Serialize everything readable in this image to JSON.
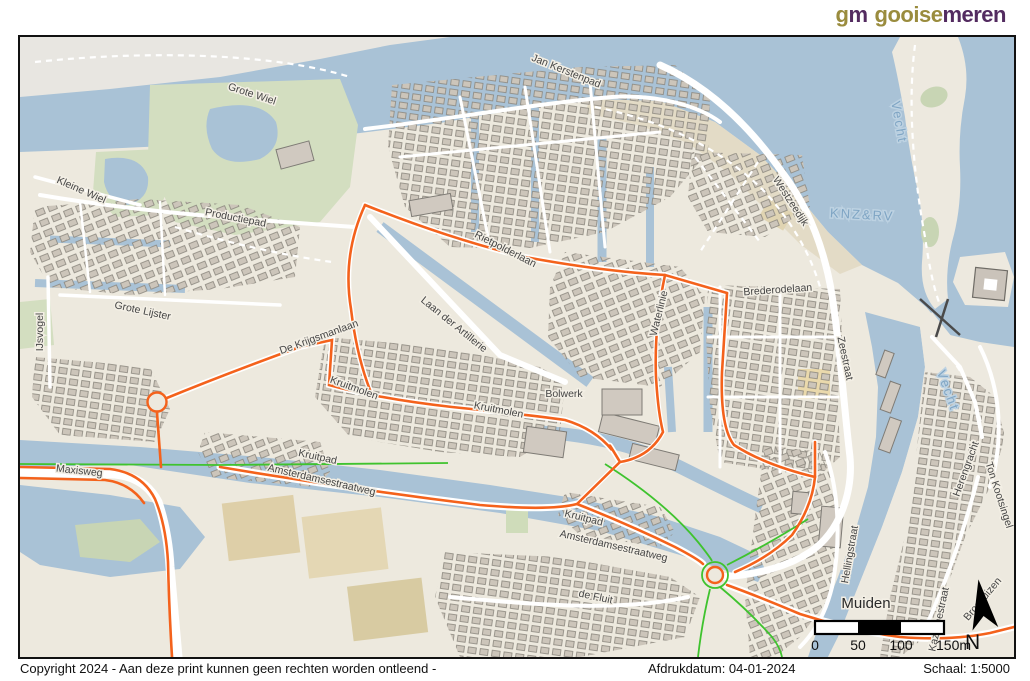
{
  "header": {
    "logo": {
      "mark_g": "g",
      "mark_m": "m",
      "name_first": "gooise",
      "name_second": "meren"
    },
    "colors": {
      "olive": "#9a8c3e",
      "purple": "#532b60"
    }
  },
  "map": {
    "labels": [
      {
        "text": "Jan Kerstenpad"
      },
      {
        "text": "Grote Wiel"
      },
      {
        "text": "Kleine Wiel"
      },
      {
        "text": "Productiepad"
      },
      {
        "text": "Grote Lijster"
      },
      {
        "text": "IJsvogel"
      },
      {
        "text": "De Krijgsmanlaan"
      },
      {
        "text": "Laan der Artillerie"
      },
      {
        "text": "Rietpolderlaan"
      },
      {
        "text": "Westzeedijk"
      },
      {
        "text": "Vecht"
      },
      {
        "text": "KNZ&RV"
      },
      {
        "text": "Brederodelaan"
      },
      {
        "text": "Zeestraat"
      },
      {
        "text": "Waterlinie"
      },
      {
        "text": "Bolwerk"
      },
      {
        "text": "Kruitmolen"
      },
      {
        "text": "Kruitmolen"
      },
      {
        "text": "Kruitpad"
      },
      {
        "text": "Kruitpad"
      },
      {
        "text": "Maxisweg"
      },
      {
        "text": "Amsterdamsestraatweg"
      },
      {
        "text": "Amsterdamsestraatweg"
      },
      {
        "text": "de Fluit"
      },
      {
        "text": "Muiden"
      },
      {
        "text": "Hellingstraat"
      },
      {
        "text": "Herengracht"
      },
      {
        "text": "Ton Kootsingel"
      },
      {
        "text": "Kazernestraat"
      },
      {
        "text": "Vecht"
      },
      {
        "text": "Broshuizen"
      }
    ],
    "colors": {
      "water": "#a9c2d6",
      "land": "#ede9de",
      "park": "#d3dec0",
      "route_orange": "#f4621c",
      "cycle_green": "#3fc32e",
      "building": "#ccc5ba"
    }
  },
  "scalebar": {
    "ticks": [
      "0",
      "50",
      "100",
      "150m"
    ]
  },
  "north_label": "N",
  "footer": {
    "copyright": "Copyright 2024 - Aan deze print kunnen geen rechten worden ontleend -",
    "print_date": "Afdrukdatum: 04-01-2024",
    "scale": "Schaal: 1:5000"
  }
}
